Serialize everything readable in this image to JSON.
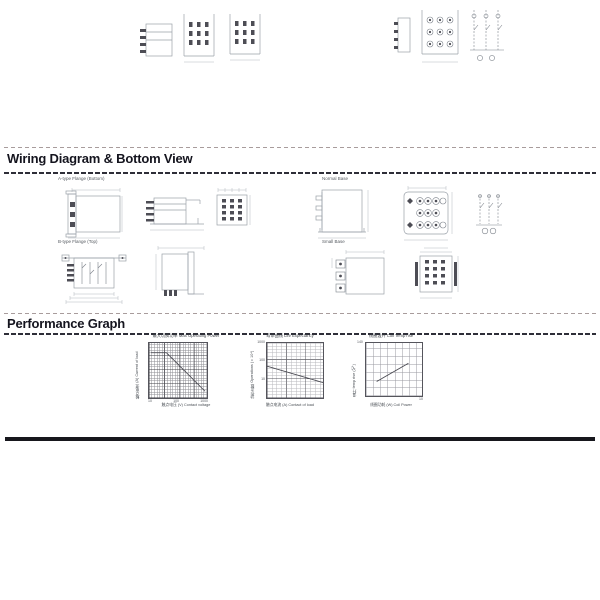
{
  "headings": {
    "wiring": "Wiring Diagram & Bottom View",
    "performance": "Performance Graph"
  },
  "wiring_labels": {
    "flange_bottom": "A-type Flange (Bottom)",
    "normal_base": "Normal Base",
    "flange_top": "B-type Flange (Top)",
    "small_base": "Small Base"
  },
  "graphs": {
    "g1": {
      "title": "最大切换功率 Max Operating Power",
      "ylabel": "触点电流 (A) Current of load",
      "xlabel": "触点电压 (V) Contact voltage",
      "xticks": [
        "10",
        "100",
        "1000"
      ]
    },
    "g2": {
      "title": "寿命曲线 Life Expectancy",
      "ylabel": "动作次数 Operations (×10⁴)",
      "xlabel": "触点电流 (A) Contact of load",
      "yticks": [
        "1000",
        "100",
        "10"
      ]
    },
    "g3": {
      "title": "线圈温升 Coil Temp rise",
      "ylabel": "温升 temp rise (℃)",
      "xlabel": "线圈功耗 (W) Coil Power",
      "ytick_top": "140",
      "xtick_right": "10"
    }
  },
  "chart_data": [
    {
      "type": "line",
      "title": "最大切换功率 Max Operating Power",
      "xlabel": "触点电压 (V) Contact voltage",
      "ylabel": "触点电流 (A) Current of load",
      "xscale": "log",
      "yscale": "log",
      "xlim": [
        10,
        1000
      ],
      "ylim": [
        0.1,
        10
      ],
      "xticks": [
        10,
        100,
        1000
      ],
      "grid": true,
      "series": [
        {
          "name": "Max operating power limit",
          "points": [
            [
              10,
              10
            ],
            [
              24,
              10
            ],
            [
              100,
              4
            ],
            [
              300,
              1.3
            ],
            [
              1000,
              0.4
            ]
          ]
        }
      ]
    },
    {
      "type": "line",
      "title": "寿命曲线 Life Expectancy",
      "xlabel": "触点电流 (A) Contact of load",
      "ylabel": "动作次数 Operations (×10⁴)",
      "yscale": "log",
      "xlim": [
        0,
        15
      ],
      "ylim": [
        10,
        1000
      ],
      "yticks": [
        1000,
        100,
        10
      ],
      "grid": true,
      "series": [
        {
          "name": "Life expectancy",
          "points": [
            [
              0,
              300
            ],
            [
              5,
              140
            ],
            [
              10,
              70
            ],
            [
              15,
              30
            ]
          ]
        }
      ]
    },
    {
      "type": "line",
      "title": "线圈温升 Coil Temp rise",
      "xlabel": "线圈功耗 (W) Coil Power",
      "ylabel": "温升 temp rise (℃)",
      "xlim": [
        0,
        10
      ],
      "ylim": [
        0,
        140
      ],
      "yticks": [
        0,
        140
      ],
      "grid": true,
      "series": [
        {
          "name": "Coil temperature rise",
          "points": [
            [
              1.5,
              35
            ],
            [
              4,
              55
            ],
            [
              7,
              80
            ]
          ]
        }
      ]
    }
  ]
}
